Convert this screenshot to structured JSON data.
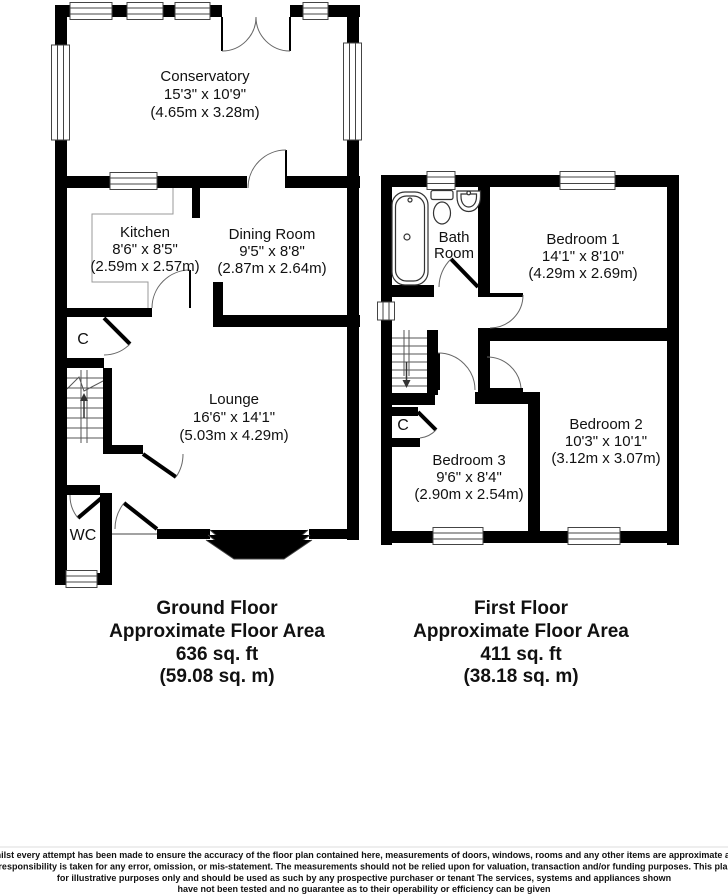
{
  "ground_floor": {
    "caption": [
      "Ground Floor",
      "Approximate Floor Area",
      "636 sq. ft",
      "(59.08 sq. m)"
    ],
    "rooms": {
      "conservatory": {
        "name": "Conservatory",
        "size_imperial": "15'3\" x 10'9\"",
        "size_metric": "(4.65m x 3.28m)"
      },
      "kitchen": {
        "name": "Kitchen",
        "size_imperial": "8'6\" x 8'5\"",
        "size_metric": "(2.59m x 2.57m)"
      },
      "dining_room": {
        "name": "Dining Room",
        "size_imperial": "9'5\" x 8'8\"",
        "size_metric": "(2.87m x 2.64m)"
      },
      "lounge": {
        "name": "Lounge",
        "size_imperial": "16'6\" x 14'1\"",
        "size_metric": "(5.03m x 4.29m)"
      },
      "wc": {
        "name": "WC"
      },
      "cupboard": {
        "name": "C"
      }
    }
  },
  "first_floor": {
    "caption": [
      "First Floor",
      "Approximate Floor Area",
      "411 sq. ft",
      "(38.18 sq. m)"
    ],
    "rooms": {
      "bathroom": {
        "name_line1": "Bath",
        "name_line2": "Room"
      },
      "bedroom1": {
        "name": "Bedroom 1",
        "size_imperial": "14'1\" x 8'10\"",
        "size_metric": "(4.29m x 2.69m)"
      },
      "bedroom2": {
        "name": "Bedroom 2",
        "size_imperial": "10'3\" x 10'1\"",
        "size_metric": "(3.12m x 3.07m)"
      },
      "bedroom3": {
        "name": "Bedroom 3",
        "size_imperial": "9'6\" x 8'4\"",
        "size_metric": "(2.90m x 2.54m)"
      },
      "cupboard": {
        "name": "C"
      }
    }
  },
  "disclaimer": [
    "Whilst every attempt has been made to ensure the accuracy of the floor plan contained here, measurements of doors, windows, rooms and any other items are approximate and",
    "no responsibility is taken for any error, omission, or mis-statement. The measurements should not be relied upon for valuation, transaction and/or funding purposes. This plan is",
    "for illustrative purposes only and should be used as such by any prospective purchaser or tenant The services, systems and appliances shown",
    "have not been tested and no guarantee as to their operability or efficiency can be given"
  ],
  "colors": {
    "wall": "#000000",
    "background": "#ffffff",
    "thin_line": "#555555"
  }
}
